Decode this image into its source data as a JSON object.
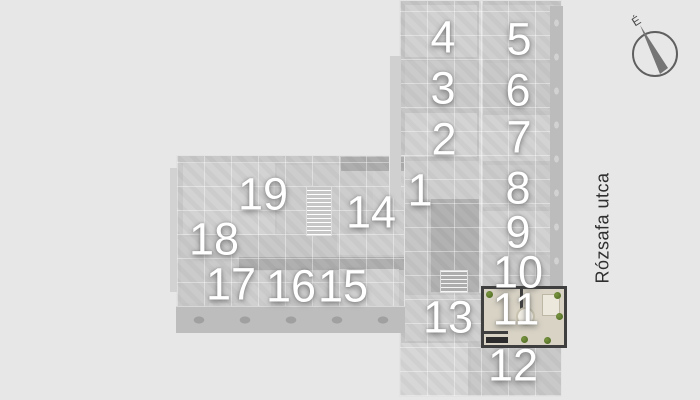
{
  "street_label": "Rózsafa utca",
  "compass": {
    "north_label": "É"
  },
  "selected_unit": "11",
  "units": [
    {
      "label": "1"
    },
    {
      "label": "2"
    },
    {
      "label": "3"
    },
    {
      "label": "4"
    },
    {
      "label": "5"
    },
    {
      "label": "6"
    },
    {
      "label": "7"
    },
    {
      "label": "8"
    },
    {
      "label": "9"
    },
    {
      "label": "10"
    },
    {
      "label": "11"
    },
    {
      "label": "12"
    },
    {
      "label": "13"
    },
    {
      "label": "14"
    },
    {
      "label": "15"
    },
    {
      "label": "16"
    },
    {
      "label": "17"
    },
    {
      "label": "18"
    },
    {
      "label": "19"
    }
  ],
  "colors": {
    "background": "#e7e7e7",
    "plan_base": "#c8c8c8",
    "selected_floor": "#d8d3c5",
    "selected_wall": "#3f3f3f",
    "plant_green": "#5e7c2f",
    "unit_number": "#ffffff",
    "street_text": "#2f2f2f"
  }
}
